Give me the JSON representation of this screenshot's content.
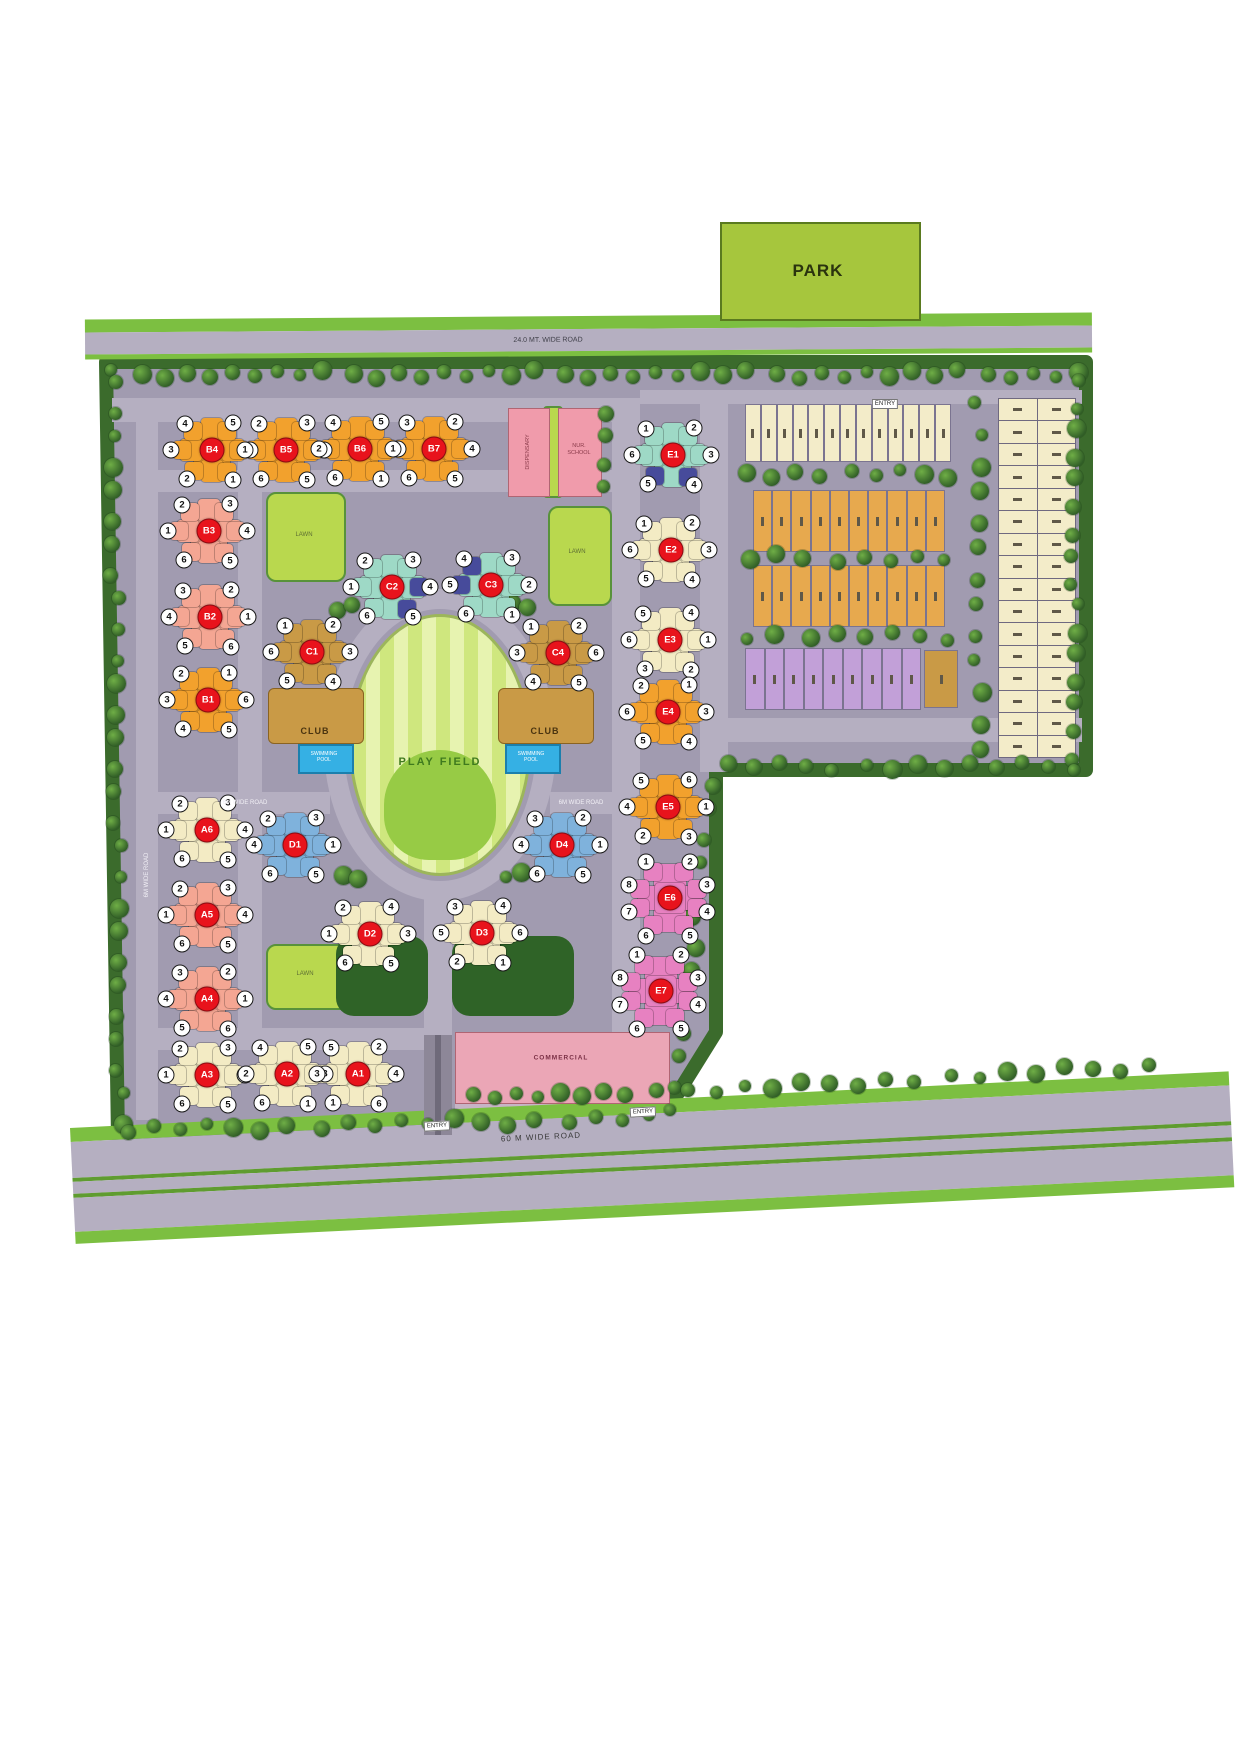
{
  "park": {
    "label": "PARK"
  },
  "roads": {
    "top_label": "24.0 MT. WIDE ROAD",
    "bottom_label": "60 M WIDE ROAD",
    "internal_labels": [
      "6M WIDE ROAD",
      "6M WIDE ROAD",
      "6M WIDE ROAD"
    ],
    "entries": [
      "ENTRY",
      "ENTRY",
      "ENTRY"
    ]
  },
  "amenities": {
    "play_field": "PLAY FIELD",
    "clubs": [
      "CLUB",
      "CLUB"
    ],
    "pools": [
      "SWIMMING POOL",
      "SWIMMING POOL"
    ],
    "dispensary": "DISPENSARY",
    "school": "NUR. SCHOOL",
    "commercial": "COMMERCIAL",
    "lawns": [
      "LAWN",
      "LAWN",
      "LAWN"
    ]
  },
  "colors": {
    "ground": "#a19bb0",
    "road": "#b5afc1",
    "roadGreen": "#7cbf41",
    "roadGreenDark": "#5f9c30",
    "treeBorder": "#3b6b2c",
    "badge": "#e8131c",
    "orange": "#f2a12d",
    "salmon": "#f4a693",
    "cream": "#f3ebc4",
    "tan": "#c99a46",
    "mint": "#9ed9c6",
    "blue": "#474b9b",
    "ltblue": "#7fb2dc",
    "magenta": "#e781c1",
    "purple": "#c2a0d8",
    "plotCream": "#f3ecc9",
    "plotOrange": "#e7a94e",
    "park": "#a6c63d",
    "field1": "#cfe77e",
    "field2": "#e7f3b0",
    "fieldInner": "#97cb45",
    "lawn": "#b9d84e",
    "pool": "#35b0e4",
    "pinkBldg": "#f09bab",
    "commercial": "#eba6b6",
    "entryDrive": "#8d8798"
  },
  "clusters": [
    {
      "id": "B4",
      "x": 212,
      "y": 450,
      "color": "orange",
      "units": [
        4,
        5,
        3,
        6,
        2,
        1
      ]
    },
    {
      "id": "B5",
      "x": 286,
      "y": 450,
      "color": "orange",
      "units": [
        2,
        3,
        1,
        4,
        6,
        5
      ]
    },
    {
      "id": "B6",
      "x": 360,
      "y": 449,
      "color": "orange",
      "units": [
        4,
        5,
        2,
        3,
        6,
        1
      ]
    },
    {
      "id": "B7",
      "x": 434,
      "y": 449,
      "color": "orange",
      "units": [
        3,
        2,
        1,
        4,
        6,
        5
      ]
    },
    {
      "id": "B3",
      "x": 209,
      "y": 531,
      "color": "salmon",
      "units": [
        2,
        3,
        1,
        4,
        6,
        5
      ]
    },
    {
      "id": "B2",
      "x": 210,
      "y": 617,
      "color": "salmon",
      "units": [
        3,
        2,
        4,
        1,
        5,
        6
      ]
    },
    {
      "id": "B1",
      "x": 208,
      "y": 700,
      "color": "orange",
      "units": [
        2,
        1,
        3,
        6,
        4,
        5
      ]
    },
    {
      "id": "A6",
      "x": 207,
      "y": 830,
      "color": "cream",
      "units": [
        2,
        3,
        1,
        4,
        6,
        5
      ]
    },
    {
      "id": "A5",
      "x": 207,
      "y": 915,
      "color": "salmon",
      "units": [
        2,
        3,
        1,
        4,
        6,
        5
      ]
    },
    {
      "id": "A4",
      "x": 207,
      "y": 999,
      "color": "salmon",
      "units": [
        3,
        2,
        4,
        1,
        5,
        6
      ]
    },
    {
      "id": "A3",
      "x": 207,
      "y": 1075,
      "color": "cream",
      "units": [
        2,
        3,
        1,
        4,
        6,
        5
      ]
    },
    {
      "id": "A2",
      "x": 287,
      "y": 1074,
      "color": "cream",
      "units": [
        4,
        5,
        2,
        3,
        6,
        1
      ]
    },
    {
      "id": "A1",
      "x": 358,
      "y": 1074,
      "color": "cream",
      "units": [
        5,
        2,
        3,
        4,
        1,
        6
      ]
    },
    {
      "id": "C2",
      "x": 392,
      "y": 587,
      "color": "mint",
      "units": [
        2,
        3,
        1,
        4,
        6,
        5
      ],
      "blueUnits": [
        4,
        5
      ]
    },
    {
      "id": "C3",
      "x": 491,
      "y": 585,
      "color": "mint",
      "units": [
        4,
        3,
        5,
        2,
        6,
        1
      ],
      "blueUnits": [
        4,
        5
      ]
    },
    {
      "id": "C1",
      "x": 312,
      "y": 652,
      "color": "tan",
      "units": [
        1,
        2,
        6,
        3,
        5,
        4
      ]
    },
    {
      "id": "C4",
      "x": 558,
      "y": 653,
      "color": "tan",
      "units": [
        1,
        2,
        3,
        6,
        4,
        5
      ]
    },
    {
      "id": "D1",
      "x": 295,
      "y": 845,
      "color": "ltblue",
      "units": [
        2,
        3,
        4,
        1,
        6,
        5
      ]
    },
    {
      "id": "D4",
      "x": 562,
      "y": 845,
      "color": "ltblue",
      "units": [
        3,
        2,
        4,
        1,
        6,
        5
      ]
    },
    {
      "id": "D2",
      "x": 370,
      "y": 934,
      "color": "cream",
      "units": [
        2,
        4,
        1,
        3,
        6,
        5
      ]
    },
    {
      "id": "D3",
      "x": 482,
      "y": 933,
      "color": "cream",
      "units": [
        3,
        4,
        5,
        6,
        2,
        1
      ]
    },
    {
      "id": "E1",
      "x": 673,
      "y": 455,
      "color": "mint",
      "units": [
        1,
        2,
        6,
        3,
        5,
        4
      ],
      "blueUnits": [
        5,
        4
      ]
    },
    {
      "id": "E2",
      "x": 671,
      "y": 550,
      "color": "cream",
      "units": [
        1,
        2,
        6,
        3,
        5,
        4
      ]
    },
    {
      "id": "E3",
      "x": 670,
      "y": 640,
      "color": "cream",
      "units": [
        5,
        4,
        6,
        1,
        3,
        2
      ]
    },
    {
      "id": "E4",
      "x": 668,
      "y": 712,
      "color": "orange",
      "units": [
        2,
        1,
        6,
        3,
        5,
        4
      ]
    },
    {
      "id": "E5",
      "x": 668,
      "y": 807,
      "color": "orange",
      "units": [
        5,
        6,
        4,
        1,
        2,
        3
      ]
    },
    {
      "id": "E6",
      "x": 670,
      "y": 898,
      "color": "magenta",
      "units": [
        1,
        2,
        8,
        3,
        7,
        4,
        6,
        5
      ]
    },
    {
      "id": "E7",
      "x": 661,
      "y": 991,
      "color": "magenta",
      "units": [
        1,
        2,
        8,
        3,
        7,
        4,
        6,
        5
      ]
    }
  ],
  "plot_rows": [
    {
      "id": "plot-row-1",
      "x": 745,
      "y": 404,
      "w": 206,
      "h": 58,
      "count": 13,
      "color": "plotCream"
    },
    {
      "id": "plot-row-2",
      "x": 753,
      "y": 490,
      "w": 192,
      "h": 62,
      "count": 10,
      "color": "plotOrange"
    },
    {
      "id": "plot-row-3",
      "x": 753,
      "y": 565,
      "w": 192,
      "h": 62,
      "count": 10,
      "color": "plotOrange"
    },
    {
      "id": "plot-row-4",
      "x": 745,
      "y": 648,
      "w": 176,
      "h": 62,
      "count": 9,
      "color": "purple"
    },
    {
      "id": "plot-row-4b",
      "x": 924,
      "y": 650,
      "w": 34,
      "h": 58,
      "count": 1,
      "color": "tan"
    }
  ],
  "far_right_grid": {
    "x": 998,
    "y": 398,
    "w": 76,
    "h": 358,
    "rows": 16,
    "cols": 2,
    "color": "plotCream"
  }
}
